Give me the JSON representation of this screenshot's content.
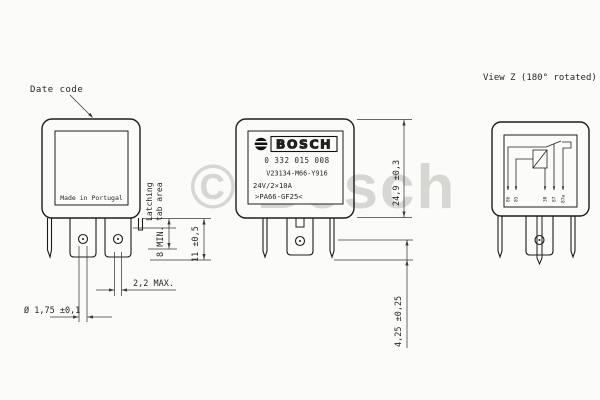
{
  "drawing": {
    "watermark": "© Bosch",
    "left_view": {
      "date_code_label": "Date code",
      "made_in": "Made in Portugal",
      "dim_pin_hole": "Ø 1,75 ±0,1",
      "dim_tab_thickness": "2,2 MAX.",
      "dim_latch_min": "8 MIN.",
      "latch_area_line1": "Latching",
      "latch_area_line2": "tab area",
      "dim_pin_length": "11 ±0,5"
    },
    "front_view": {
      "brand": "BOSCH",
      "part_number": "0 332 015 008",
      "type_code": "V23134-M66-Y916",
      "rating": "24V/2×10A",
      "material": ">PA66-GF25<",
      "dim_height": "24,9 ±0,3",
      "dim_pin_offset": "4,25 ±0,25"
    },
    "view_z": {
      "title": "View Z (180° rotated)",
      "terminals": [
        "86",
        "85",
        "30",
        "87",
        "87a"
      ]
    },
    "colors": {
      "line": "#1c1c1c",
      "dim_line": "#3a3a3a",
      "watermark": "#d6d6d3",
      "background": "#fbfbf9"
    }
  }
}
